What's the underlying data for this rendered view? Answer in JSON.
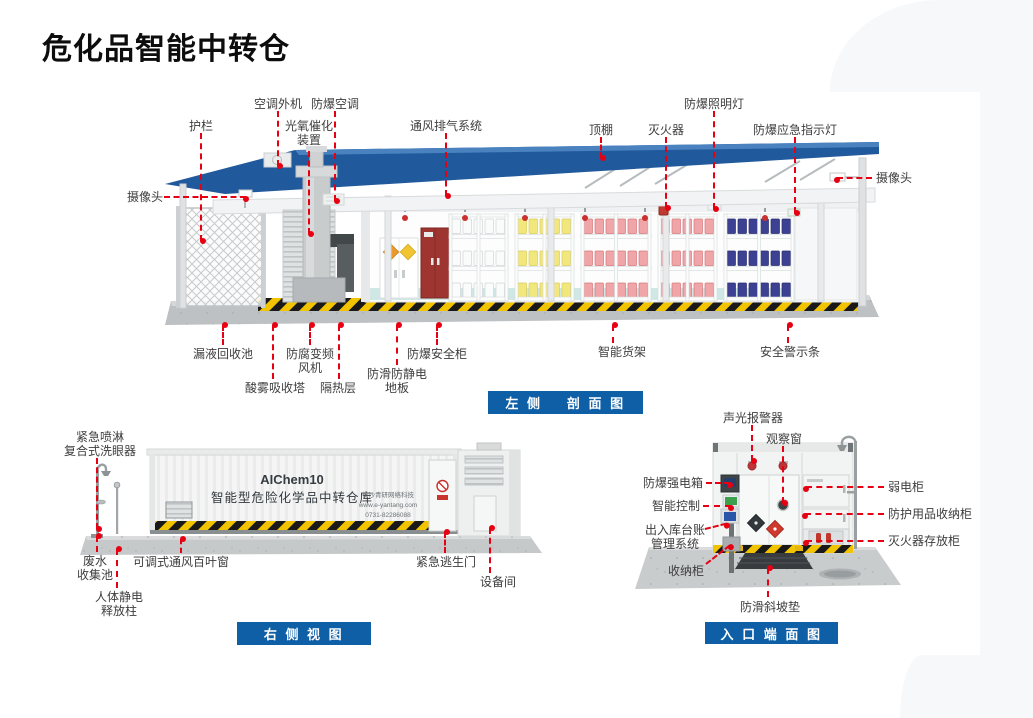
{
  "title": "危化品智能中转仓",
  "colors": {
    "leader_red": "#e60012",
    "caption_blue": "#0e5fa6",
    "roof_blue": "#20599c",
    "hazard_yellow": "#f2c400"
  },
  "views": {
    "left_section": {
      "caption": "左 侧    剖 面 图",
      "labels": {
        "guardrail": "护栏",
        "camera_left": "摄像头",
        "ac_outdoor": "空调外机",
        "photo_oxy": "光氧催化\n装置",
        "ex_ac": "防爆空调",
        "vent_system": "通风排气系统",
        "canopy": "顶棚",
        "extinguisher": "灭火器",
        "ex_light": "防爆照明灯",
        "ex_indicator": "防爆应急指示灯",
        "camera_right": "摄像头",
        "leak_pool": "漏液回收池",
        "acid_tower": "酸雾吸收塔",
        "fan": "防腐变频\n风机",
        "insulation": "隔热层",
        "antistatic_floor": "防滑防静电\n地板",
        "safety_cabinet": "防爆安全柜",
        "smart_rack": "智能货架",
        "warning_strip": "安全警示条"
      }
    },
    "right_view": {
      "caption": "右 侧 视 图",
      "labels": {
        "eyewash": "紧急喷淋\n复合式洗眼器",
        "waste_pool": "废水\n收集池",
        "static_pole": "人体静电\n释放柱",
        "louver": "可调式通风百叶窗",
        "escape_door": "紧急逃生门",
        "equipment_room": "设备间"
      },
      "container": {
        "model": "AIChem10",
        "name": "智能型危险化学品中转仓库",
        "company": "长沙青研网络科技",
        "website": "www.e-yantang.com",
        "phone": "0731-82286088"
      }
    },
    "entrance_view": {
      "caption": "入 口 端 面 图",
      "labels": {
        "alarm": "声光报警器",
        "window": "观察窗",
        "power_box": "防爆强电箱",
        "smart_ctrl": "智能控制",
        "ledger": "出入库台账\n管理系统",
        "cabinet": "收纳柜",
        "ramp": "防滑斜坡垫",
        "weak_box": "弱电柜",
        "ppe_cabinet": "防护用品收纳柜",
        "ext_cabinet": "灭火器存放柜"
      }
    }
  }
}
